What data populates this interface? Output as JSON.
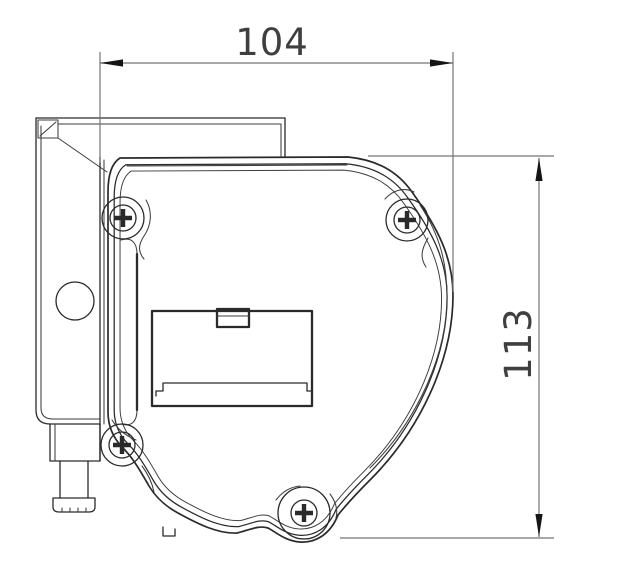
{
  "drawing": {
    "dimensions": {
      "width": {
        "value": "104",
        "orientation": "horizontal"
      },
      "height": {
        "value": "113",
        "orientation": "vertical"
      }
    }
  },
  "colors": {
    "background": "#ffffff",
    "part_line": "#2a2a2a",
    "dimension_line": "#747474",
    "arrow": "#151515",
    "text": "#3f3f3f"
  }
}
